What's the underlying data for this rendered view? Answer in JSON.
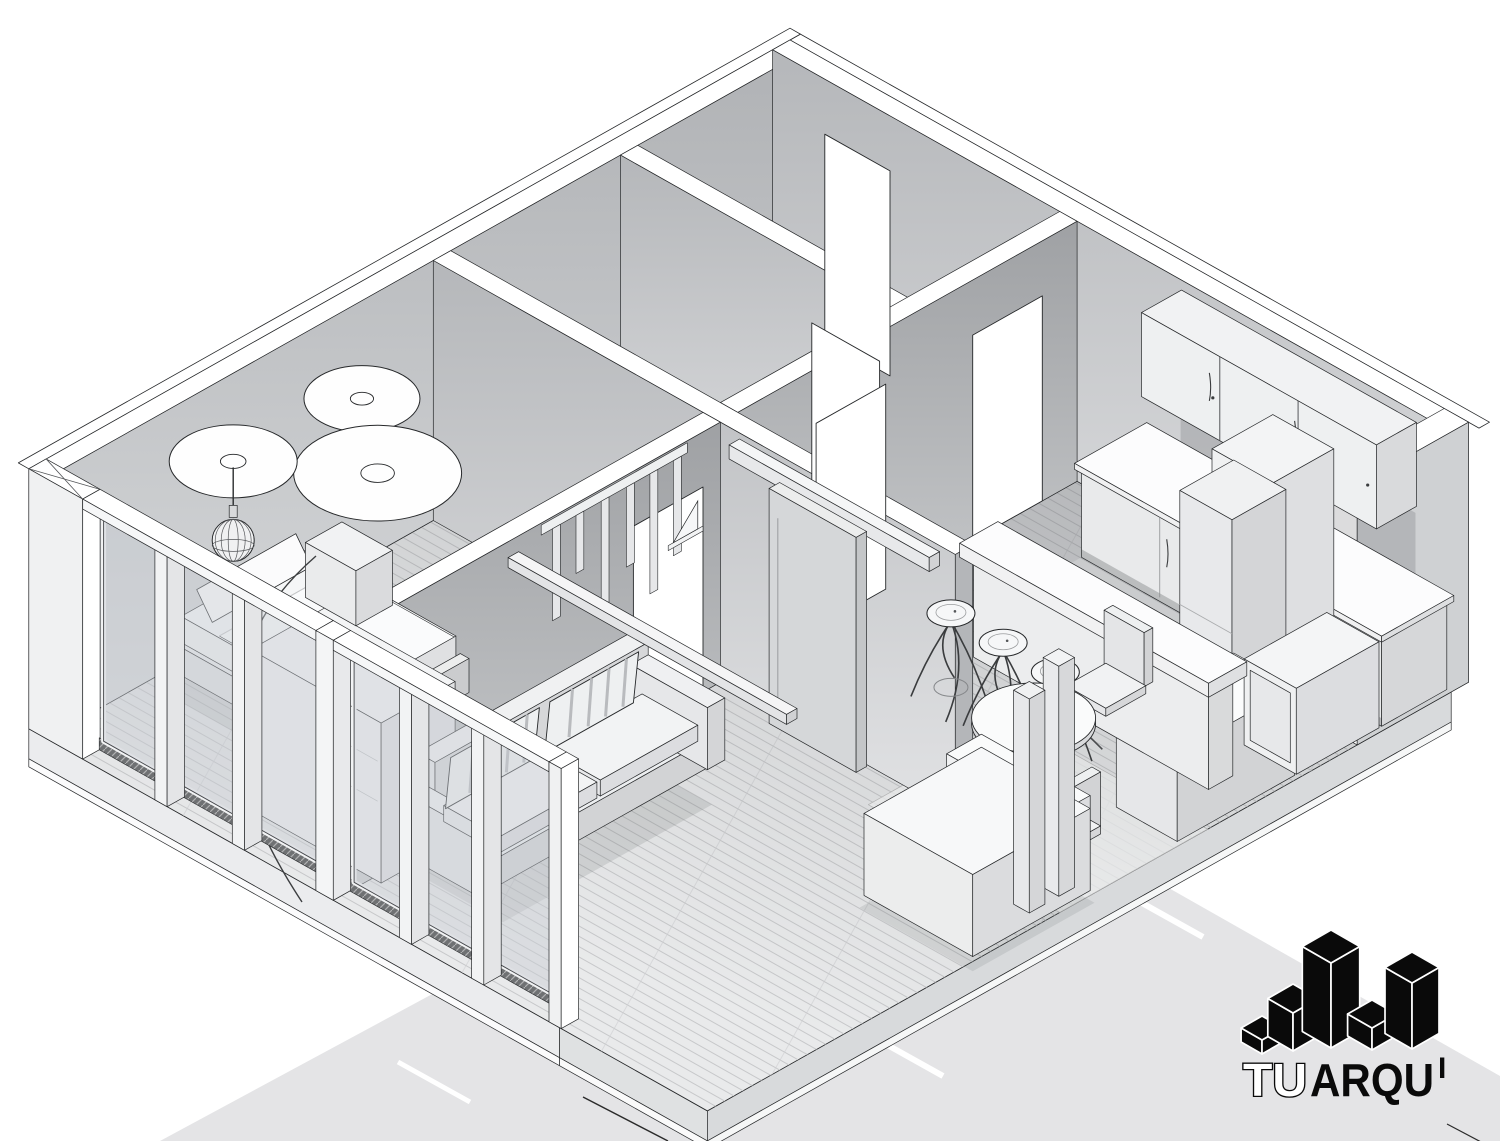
{
  "title": "Isometric 3D cutaway rendering of a one-bedroom apartment floor plan",
  "brand": {
    "logo_text": "TUARQUI",
    "tu": "TU",
    "arqui": "ARQU",
    "i": "I"
  },
  "palette": {
    "background": "#ffffff",
    "ground_shadow": "#e4e4e6",
    "wall_cut_top": "#ffffff",
    "wall_face_light": "#dcdee0",
    "wall_face_dark": "#b2b4b7",
    "floor": "#e9eaeb",
    "floor_back_rooms": "#9b9da1",
    "glass": "rgba(200,205,210,0.45)",
    "outline": "#222222",
    "logo_black": "#0a0a0a"
  },
  "scene": {
    "rooms": [
      "bedroom",
      "living-room",
      "kitchen",
      "bathroom",
      "closet",
      "hallway"
    ],
    "furniture": [
      "bed",
      "wardrobe",
      "pendant-lamp",
      "ceiling-light-discs",
      "curtain",
      "sofa",
      "wall-slat-panel",
      "ceiling-rail",
      "sliding-door",
      "bar-counter",
      "bar-stools",
      "dining-table",
      "dining-chairs",
      "upper-cabinets",
      "base-cabinets",
      "refrigerator",
      "pantry-column",
      "sink",
      "island-desk",
      "glazed-facade"
    ]
  }
}
